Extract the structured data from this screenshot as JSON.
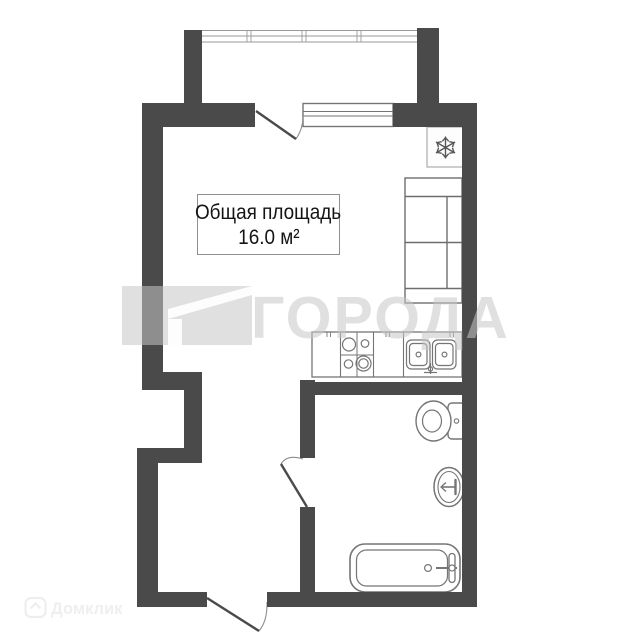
{
  "floor_plan": {
    "area_label": {
      "title": "Общая площадь",
      "value": "16.0 м²"
    },
    "fixtures": {
      "fridge_icon": "snowflake-fridge",
      "stove_icon": "four-burner-stove",
      "kitchen_sink_icon": "double-basin-sink-with-faucet",
      "sofa_icon": "two-seat-sofa",
      "toilet_icon": "toilet-with-tank",
      "washbasin_icon": "oval-washbasin-with-faucet",
      "bathtub_icon": "bathtub-with-faucet",
      "window_icon": "window",
      "balcony_glazing_icon": "glazed-balcony-front",
      "door_icons": [
        "balcony-door-swing",
        "bathroom-door-swing",
        "entrance-door-swing"
      ]
    },
    "colors": {
      "wall": "#4a4a4a",
      "fixture_stroke": "#757575",
      "door_leaf": "#4a4a4a",
      "label_border": "#8f8f8f"
    }
  },
  "watermarks": {
    "center": {
      "text": "ГОРОДА",
      "logo": "corner-flag-logo",
      "color": "#e6e6e6"
    },
    "corner": {
      "text": "Домклик",
      "logo": "house-badge-logo",
      "color": "#efefef"
    }
  }
}
